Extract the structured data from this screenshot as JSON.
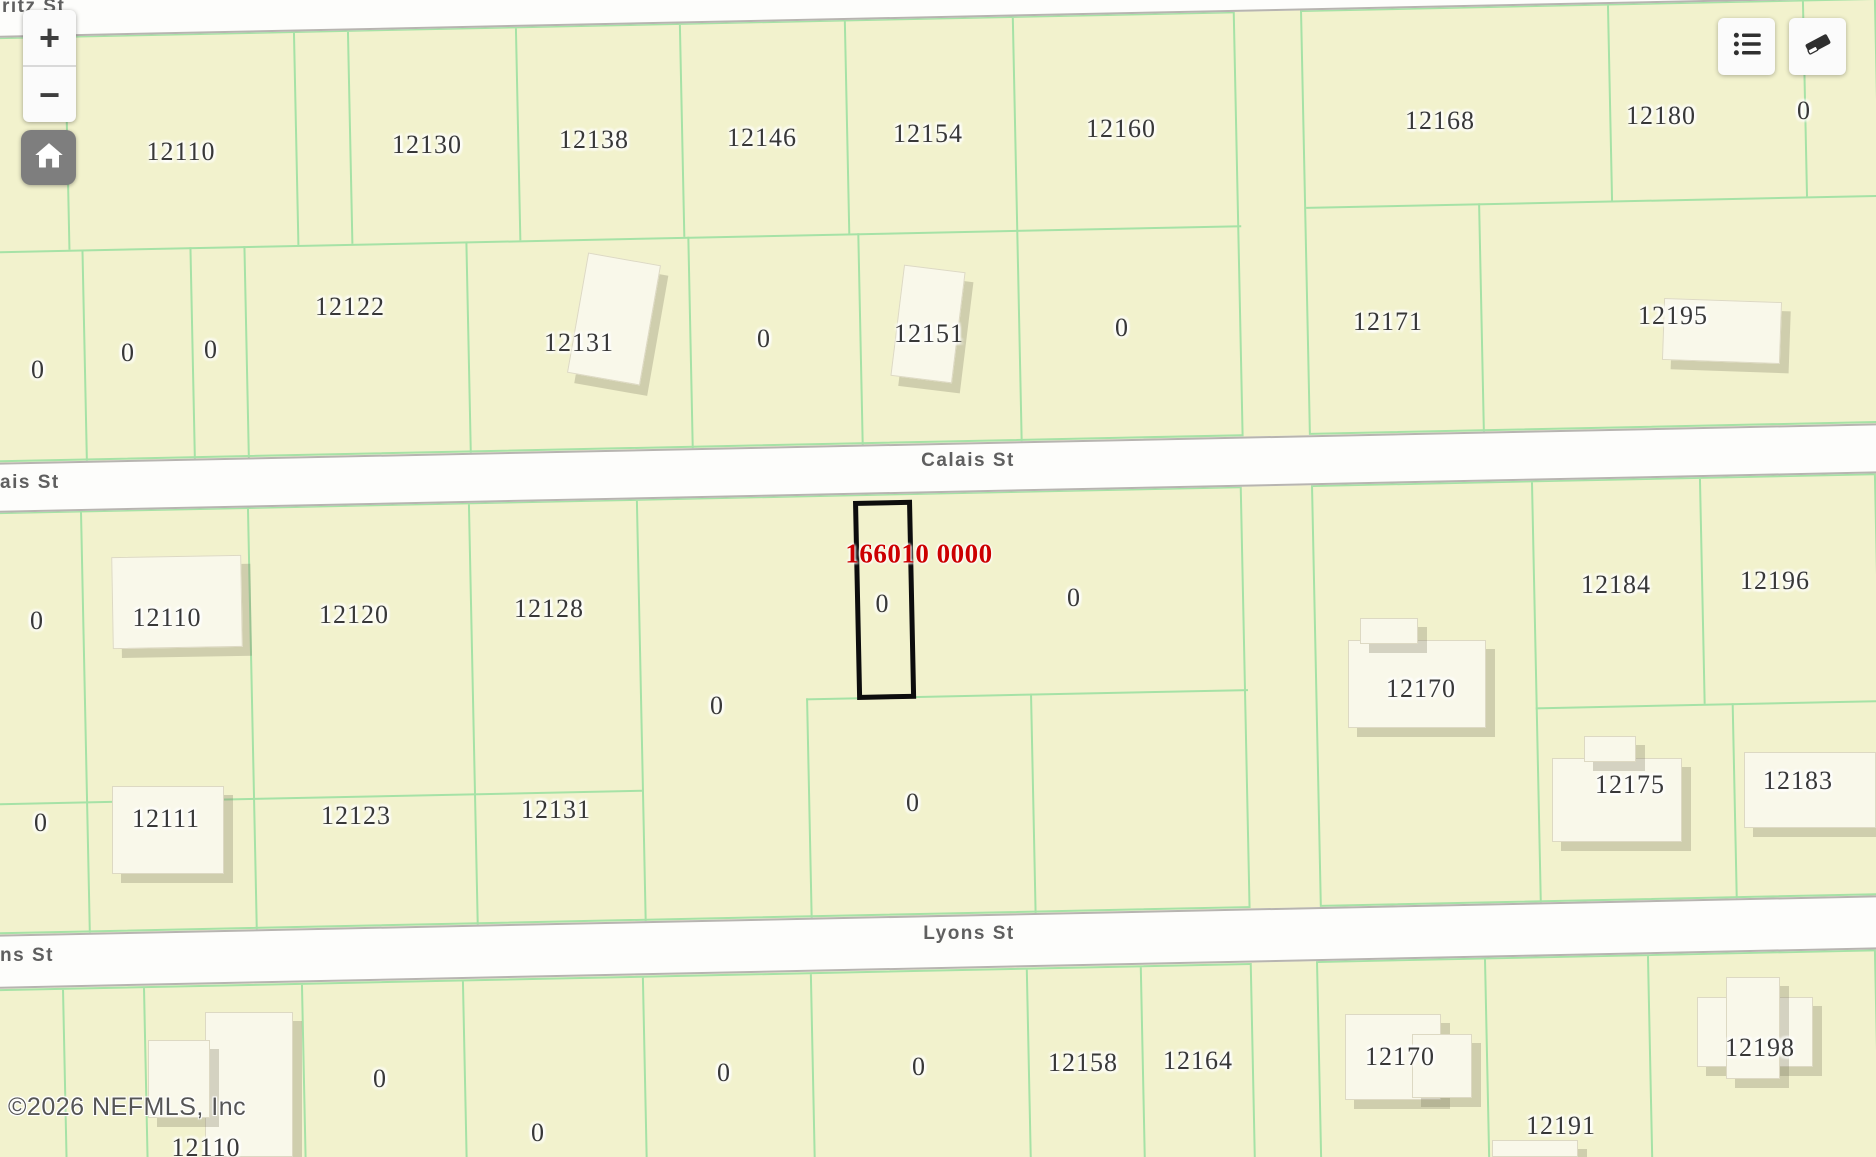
{
  "ui": {
    "attribution": "©2026 NEFMLS, Inc",
    "controls": {
      "zoom_in_label": "+",
      "zoom_out_label": "−"
    }
  },
  "map": {
    "streets": {
      "top_partial": "ritz St",
      "calais": "Calais St",
      "calais_partial": "ais St",
      "lyons": "Lyons St",
      "lyons_partial": "ns St"
    },
    "selected_parcel": {
      "id": "166010 0000",
      "label": "0"
    },
    "colors": {
      "parcel_fill": "#f2f2cd",
      "boundary_green": "#a6e2a6",
      "street_fill": "#fdfdfb",
      "street_edge": "#b7b4b0",
      "building_fill": "#f9f8ea",
      "label_color": "#383838",
      "selected_id_color": "#cc0000",
      "selected_outline_color": "#0d0d0d"
    },
    "bands": [
      {
        "top": -33,
        "height": 51
      },
      {
        "top": 443,
        "height": 50
      },
      {
        "top": 915,
        "height": 54
      }
    ],
    "selected_box": {
      "left": 853,
      "top": 501,
      "width": 59,
      "height": 199
    },
    "selected_id_pos": {
      "x": 919,
      "y": 554
    },
    "selected_label_pos": {
      "x": 882,
      "y": 604
    },
    "parcel_labels": [
      {
        "text": "12110",
        "x": 181,
        "y": 152
      },
      {
        "text": "12130",
        "x": 427,
        "y": 145
      },
      {
        "text": "12138",
        "x": 594,
        "y": 140
      },
      {
        "text": "12146",
        "x": 762,
        "y": 138
      },
      {
        "text": "12154",
        "x": 928,
        "y": 134
      },
      {
        "text": "12160",
        "x": 1121,
        "y": 129
      },
      {
        "text": "12168",
        "x": 1440,
        "y": 121
      },
      {
        "text": "12180",
        "x": 1661,
        "y": 116
      },
      {
        "text": "0",
        "x": 1804,
        "y": 111
      },
      {
        "text": "0",
        "x": 38,
        "y": 370
      },
      {
        "text": "0",
        "x": 128,
        "y": 353
      },
      {
        "text": "0",
        "x": 211,
        "y": 350
      },
      {
        "text": "12122",
        "x": 350,
        "y": 307
      },
      {
        "text": "12131",
        "x": 579,
        "y": 343
      },
      {
        "text": "0",
        "x": 764,
        "y": 339
      },
      {
        "text": "12151",
        "x": 929,
        "y": 334
      },
      {
        "text": "0",
        "x": 1122,
        "y": 328
      },
      {
        "text": "12171",
        "x": 1388,
        "y": 322
      },
      {
        "text": "12195",
        "x": 1673,
        "y": 316
      },
      {
        "text": "0",
        "x": 37,
        "y": 621
      },
      {
        "text": "12110",
        "x": 167,
        "y": 618
      },
      {
        "text": "12120",
        "x": 354,
        "y": 615
      },
      {
        "text": "12128",
        "x": 549,
        "y": 609
      },
      {
        "text": "0",
        "x": 717,
        "y": 706
      },
      {
        "text": "0",
        "x": 1074,
        "y": 598
      },
      {
        "text": "12170",
        "x": 1421,
        "y": 689
      },
      {
        "text": "12184",
        "x": 1616,
        "y": 585
      },
      {
        "text": "12196",
        "x": 1775,
        "y": 581
      },
      {
        "text": "0",
        "x": 41,
        "y": 823
      },
      {
        "text": "12111",
        "x": 166,
        "y": 819
      },
      {
        "text": "12123",
        "x": 356,
        "y": 816
      },
      {
        "text": "12131",
        "x": 556,
        "y": 810
      },
      {
        "text": "0",
        "x": 913,
        "y": 803
      },
      {
        "text": "12175",
        "x": 1630,
        "y": 785
      },
      {
        "text": "12183",
        "x": 1798,
        "y": 781
      },
      {
        "text": "0",
        "x": 380,
        "y": 1079
      },
      {
        "text": "0",
        "x": 538,
        "y": 1133
      },
      {
        "text": "0",
        "x": 724,
        "y": 1073
      },
      {
        "text": "0",
        "x": 919,
        "y": 1067
      },
      {
        "text": "12158",
        "x": 1083,
        "y": 1063
      },
      {
        "text": "12164",
        "x": 1198,
        "y": 1061
      },
      {
        "text": "12170",
        "x": 1400,
        "y": 1057
      },
      {
        "text": "12191",
        "x": 1561,
        "y": 1126
      },
      {
        "text": "12198",
        "x": 1760,
        "y": 1048
      },
      {
        "text": "12110",
        "x": 206,
        "y": 1148
      }
    ],
    "blocks": [
      {
        "left": -40,
        "top": 38,
        "width": 1275,
        "height": 425,
        "v": [
          {
            "x": 102,
            "y1": 0,
            "y2": 212
          },
          {
            "x": 331,
            "y1": 0,
            "y2": 212
          },
          {
            "x": 385,
            "y1": 0,
            "y2": 212
          },
          {
            "x": 553,
            "y1": 0,
            "y2": 212
          },
          {
            "x": 717,
            "y1": 0,
            "y2": 212
          },
          {
            "x": 882,
            "y1": 0,
            "y2": 212
          },
          {
            "x": 1050,
            "y1": 0,
            "y2": 425
          },
          {
            "x": 115,
            "y1": 212,
            "y2": 425
          },
          {
            "x": 223,
            "y1": 212,
            "y2": 425
          },
          {
            "x": 277,
            "y1": 212,
            "y2": 425
          },
          {
            "x": 499,
            "y1": 212,
            "y2": 425
          },
          {
            "x": 721,
            "y1": 212,
            "y2": 425
          },
          {
            "x": 891,
            "y1": 212,
            "y2": 425
          }
        ],
        "h": [
          {
            "y": 212,
            "x1": 0,
            "x2": 1275
          }
        ]
      },
      {
        "left": 1300,
        "top": 10,
        "width": 576,
        "height": 425,
        "v": [
          {
            "x": 305,
            "y1": 0,
            "y2": 195
          },
          {
            "x": 500,
            "y1": 0,
            "y2": 195
          },
          {
            "x": 172,
            "y1": 195,
            "y2": 425
          }
        ],
        "h": [
          {
            "y": 195,
            "x1": 0,
            "x2": 576
          }
        ]
      },
      {
        "left": -40,
        "top": 513,
        "width": 1282,
        "height": 422,
        "v": [
          {
            "x": 118,
            "y1": 0,
            "y2": 422
          },
          {
            "x": 285,
            "y1": 0,
            "y2": 422
          },
          {
            "x": 506,
            "y1": 0,
            "y2": 422
          },
          {
            "x": 674,
            "y1": 0,
            "y2": 422
          },
          {
            "x": 840,
            "y1": 201,
            "y2": 422
          },
          {
            "x": 1064,
            "y1": 201,
            "y2": 422
          }
        ],
        "h": [
          {
            "y": 289,
            "x1": 0,
            "x2": 674
          },
          {
            "y": 201,
            "x1": 840,
            "x2": 1282
          }
        ]
      },
      {
        "left": 1311,
        "top": 485,
        "width": 565,
        "height": 422,
        "v": [
          {
            "x": 218,
            "y1": 0,
            "y2": 422
          },
          {
            "x": 386,
            "y1": 0,
            "y2": 225
          },
          {
            "x": 414,
            "y1": 225,
            "y2": 422
          }
        ],
        "h": [
          {
            "y": 225,
            "x1": 218,
            "x2": 565
          }
        ]
      },
      {
        "left": -40,
        "top": 990,
        "width": 1292,
        "height": 200,
        "v": [
          {
            "x": 100,
            "y1": 0,
            "y2": 200
          },
          {
            "x": 181,
            "y1": 0,
            "y2": 200
          },
          {
            "x": 339,
            "y1": 0,
            "y2": 200
          },
          {
            "x": 500,
            "y1": 0,
            "y2": 200
          },
          {
            "x": 680,
            "y1": 0,
            "y2": 200
          },
          {
            "x": 848,
            "y1": 0,
            "y2": 200
          },
          {
            "x": 1064,
            "y1": 0,
            "y2": 200
          },
          {
            "x": 1178,
            "y1": 0,
            "y2": 200
          }
        ],
        "h": []
      },
      {
        "left": 1316,
        "top": 961,
        "width": 560,
        "height": 230,
        "v": [
          {
            "x": 166,
            "y1": 0,
            "y2": 230
          },
          {
            "x": 329,
            "y1": 0,
            "y2": 230
          }
        ],
        "h": []
      }
    ],
    "buildings": [
      {
        "x": 577,
        "y": 258,
        "w": 74,
        "h": 122,
        "r": 10
      },
      {
        "x": 897,
        "y": 268,
        "w": 62,
        "h": 112,
        "r": 7
      },
      {
        "x": 1663,
        "y": 300,
        "w": 118,
        "h": 62,
        "r": 2
      },
      {
        "x": 112,
        "y": 556,
        "w": 130,
        "h": 92,
        "r": -1
      },
      {
        "x": 1348,
        "y": 640,
        "w": 138,
        "h": 88,
        "r": 0
      },
      {
        "x": 1360,
        "y": 618,
        "w": 58,
        "h": 26,
        "r": 0
      },
      {
        "x": 1552,
        "y": 758,
        "w": 130,
        "h": 84,
        "r": 0
      },
      {
        "x": 1584,
        "y": 736,
        "w": 52,
        "h": 26,
        "r": 0
      },
      {
        "x": 1744,
        "y": 752,
        "w": 132,
        "h": 76,
        "r": 0
      },
      {
        "x": 112,
        "y": 786,
        "w": 112,
        "h": 88,
        "r": 0
      },
      {
        "x": 205,
        "y": 1012,
        "w": 88,
        "h": 145,
        "r": 0
      },
      {
        "x": 148,
        "y": 1040,
        "w": 62,
        "h": 78,
        "r": 0
      },
      {
        "x": 1345,
        "y": 1014,
        "w": 96,
        "h": 86,
        "r": 0
      },
      {
        "x": 1412,
        "y": 1034,
        "w": 60,
        "h": 64,
        "r": 0
      },
      {
        "x": 1697,
        "y": 997,
        "w": 116,
        "h": 70,
        "r": 0
      },
      {
        "x": 1726,
        "y": 977,
        "w": 54,
        "h": 102,
        "r": 0
      },
      {
        "x": 1492,
        "y": 1140,
        "w": 86,
        "h": 17,
        "r": 0
      }
    ]
  }
}
